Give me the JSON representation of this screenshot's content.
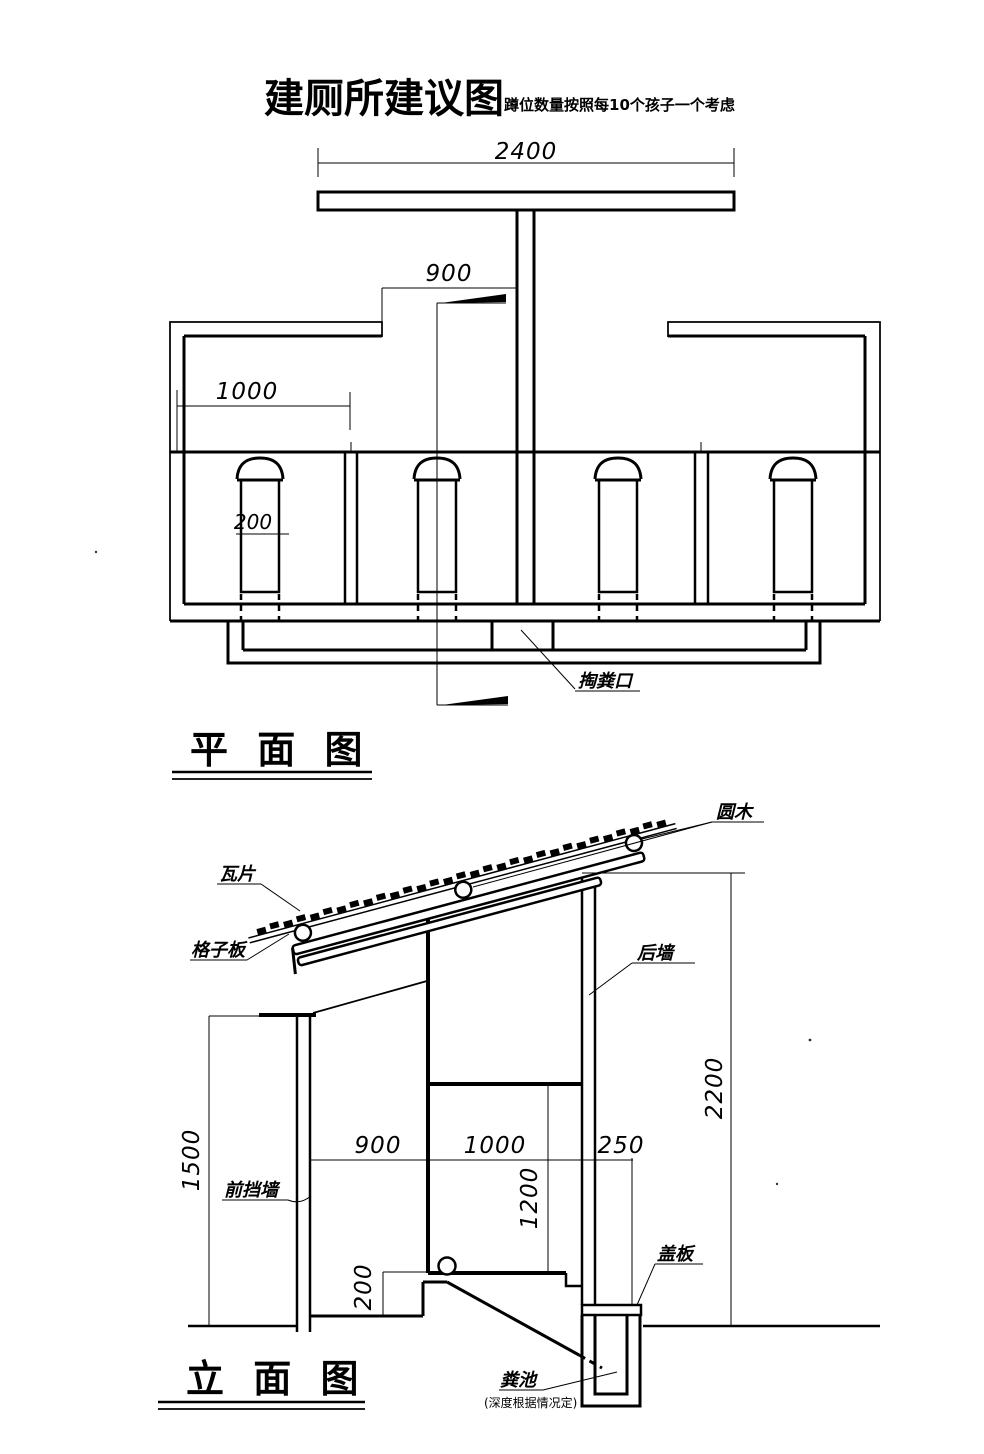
{
  "page": {
    "title": "建厕所建议图",
    "subtitle": "蹲位数量按照每10个孩子一个考虑"
  },
  "plan_view": {
    "section_title": "平 面 图",
    "dimensions": {
      "overall_width": "2400",
      "door_opening": "900",
      "stall_depth": "1000",
      "hole_width": "200"
    },
    "labels": {
      "manure_access": "掏粪口"
    }
  },
  "elevation_view": {
    "section_title": "立 面 图",
    "dimensions": {
      "front_wall_height": "1500",
      "front_bay_width": "900",
      "stall_width": "1000",
      "pit_width": "250",
      "stall_inner_height": "1200",
      "platform_height": "200",
      "rear_wall_height": "2200"
    },
    "labels": {
      "round_log": "圆木",
      "roof_tile": "瓦片",
      "lattice_board": "格子板",
      "rear_wall": "后墙",
      "front_screen_wall": "前挡墙",
      "cover_plate": "盖板",
      "manure_pit": "粪池",
      "manure_pit_note": "(深度根据情况定)"
    }
  },
  "colors": {
    "ink": "#000000",
    "background": "#ffffff"
  }
}
